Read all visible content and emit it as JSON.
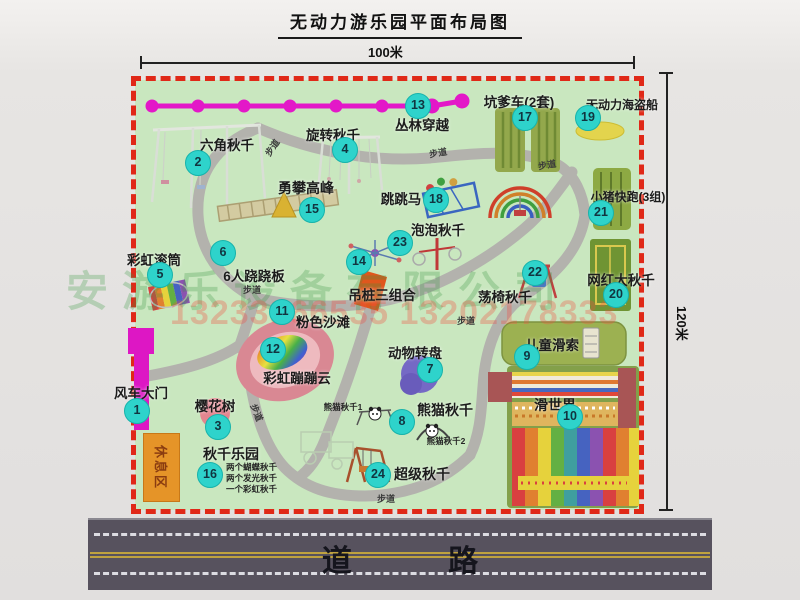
{
  "title": "无动力游乐园平面布局图",
  "dim_width": "100米",
  "dim_height": "120米",
  "road_label": "道 路",
  "path_label": "步道",
  "rest_area_label": "休息区",
  "watermark_company": "安游乐设备有限公司",
  "watermark_phone": "13233866535 13202178333",
  "panda_sub_labels": [
    "熊猫秋千1",
    "熊猫秋千2"
  ],
  "attractions": [
    {
      "num": "1",
      "label": "风车大门"
    },
    {
      "num": "2",
      "label": "六角秋千"
    },
    {
      "num": "3",
      "label": "樱花树"
    },
    {
      "num": "4",
      "label": "旋转秋千"
    },
    {
      "num": "5",
      "label": "彩虹滚筒"
    },
    {
      "num": "6",
      "label": "6人跷跷板"
    },
    {
      "num": "7",
      "label": "动物转盘"
    },
    {
      "num": "8",
      "label": "熊猫秋千"
    },
    {
      "num": "9",
      "label": "儿童滑索"
    },
    {
      "num": "10",
      "label": "滑世界"
    },
    {
      "num": "11",
      "label": "粉色沙滩"
    },
    {
      "num": "12",
      "label": "彩虹蹦蹦云"
    },
    {
      "num": "13",
      "label": "丛林穿越"
    },
    {
      "num": "14",
      "label": "吊桩三组合"
    },
    {
      "num": "15",
      "label": "勇攀高峰"
    },
    {
      "num": "16",
      "label": "秋千乐园",
      "sub": [
        "两个蝴蝶秋千",
        "两个发光秋千",
        "一个彩虹秋千"
      ]
    },
    {
      "num": "17",
      "label": "坑爹车(2套)"
    },
    {
      "num": "18",
      "label": "跳跳马"
    },
    {
      "num": "19",
      "label": "无动力海盗船"
    },
    {
      "num": "20",
      "label": "网红大秋千"
    },
    {
      "num": "21",
      "label": "小猪快跑(3组)"
    },
    {
      "num": "22",
      "label": "荡椅秋千"
    },
    {
      "num": "23",
      "label": "泡泡秋千"
    },
    {
      "num": "24",
      "label": "超级秋千"
    }
  ],
  "colors": {
    "map_green": "#c9e7bf",
    "border_red": "#e02818",
    "badge_cyan": "#2ed3cb",
    "zipline_magenta": "#dd17c4",
    "road_gray": "#57525e"
  }
}
